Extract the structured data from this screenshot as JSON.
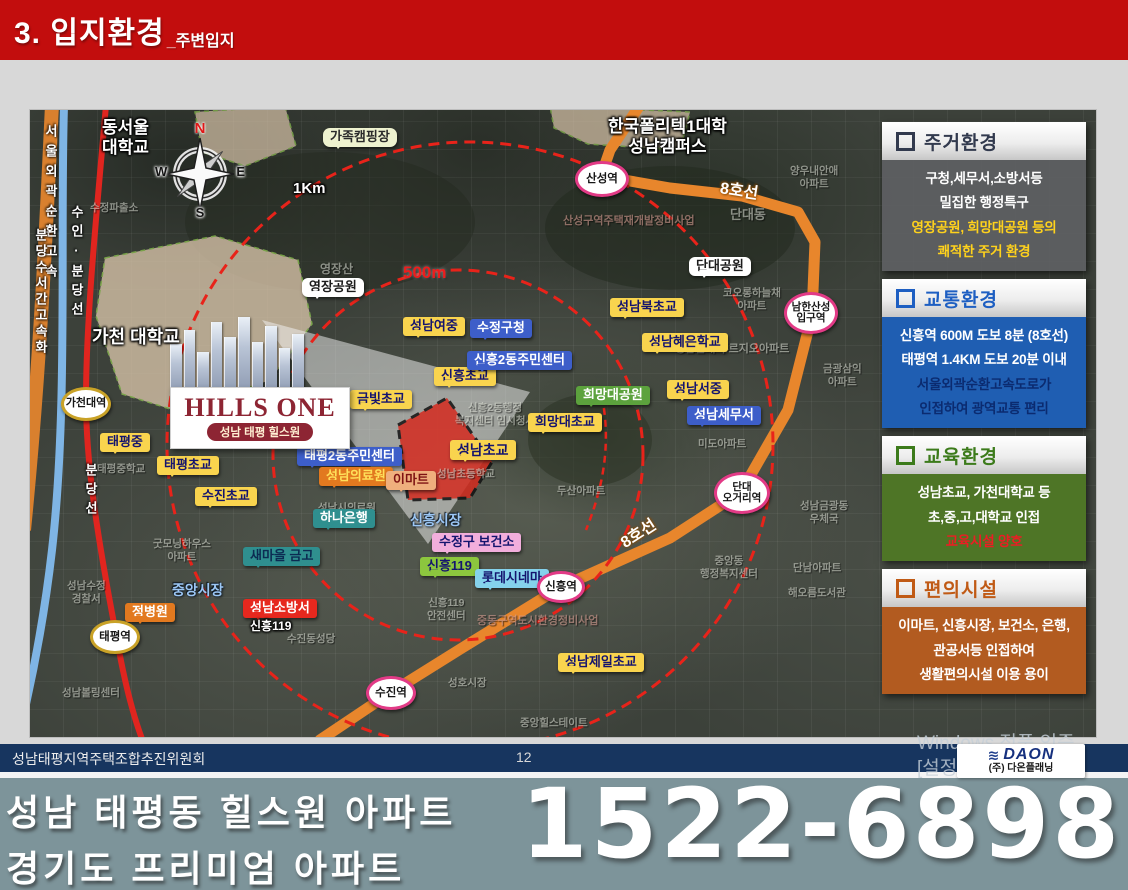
{
  "header": {
    "title": "3. 입지환경",
    "subtitle": "_주변입지"
  },
  "colors": {
    "header_bar": "#C20D0D",
    "line8_subway": "#E8862C",
    "bundang_line": "#E0251F",
    "radius_circle": "#E8231A",
    "site_fill": "#D42B1F",
    "footer_bar": "#17355F",
    "banner_bg": "#7D949A",
    "school_label": "#F9D44E",
    "public_label": "#3D5EC9"
  },
  "sidebar": {
    "panels": [
      {
        "title": "주거환경",
        "accent": "#323A4E",
        "body_bg": "rgba(96,97,100,0.88)",
        "hl": "#FFD21C",
        "lines": [
          {
            "t": "구청,세무서,소방서등"
          },
          {
            "t": "밀집한 행정특구"
          },
          {
            "t": "영장공원, 희망대공원 등의",
            "hl": true
          },
          {
            "t": "쾌적한 주거 환경",
            "hl": true
          }
        ]
      },
      {
        "title": "교통환경",
        "accent": "#1E5FC2",
        "body_bg": "#1F5EB2",
        "hl": "#0B2B70",
        "lines": [
          {
            "t": "신흥역 600M 도보 8분 (8호선)"
          },
          {
            "t": "태평역 1.4KM 도보 20분 이내"
          },
          {
            "t": "서울외곽순환고속도로가",
            "hl": true
          },
          {
            "t": "인접하여 광역교통 편리",
            "hl": true
          }
        ]
      },
      {
        "title": "교육환경",
        "accent": "#3C7B1B",
        "body_bg": "#4E7526",
        "hl": "#ED1C24",
        "lines": [
          {
            "t": "성남초교, 가천대학교 등"
          },
          {
            "t": "초,중,고,대학교 인접"
          },
          {
            "t": "교육시설 양호",
            "hl": true
          }
        ]
      },
      {
        "title": "편의시설",
        "accent": "#C05A15",
        "body_bg": "#B25B20",
        "hl": "#FFFFFF",
        "lines": [
          {
            "t": "이마트, 신흥시장, 보건소, 은행,"
          },
          {
            "t": "관공서등 인접하여"
          },
          {
            "t": "생활편의시설 이용 용이"
          }
        ]
      }
    ]
  },
  "map": {
    "project": {
      "logo": "HILLS ONE",
      "sub": "성남 태평 힐스원"
    },
    "compass": {
      "n": "N",
      "w": "W",
      "e": "E",
      "s": "S"
    },
    "labels": [
      {
        "t": "성남여중",
        "type": "y",
        "x": 373,
        "y": 207
      },
      {
        "t": "신흥초교",
        "type": "y",
        "x": 404,
        "y": 257
      },
      {
        "t": "성남북초교",
        "type": "y",
        "x": 580,
        "y": 188
      },
      {
        "t": "성남혜은학교",
        "type": "y",
        "x": 612,
        "y": 223
      },
      {
        "t": "성남서중",
        "type": "y",
        "x": 637,
        "y": 270
      },
      {
        "t": "금빛초교",
        "type": "y",
        "x": 320,
        "y": 280
      },
      {
        "t": "희망대초교",
        "type": "y",
        "x": 498,
        "y": 303
      },
      {
        "t": "성남초교",
        "type": "y",
        "x": 420,
        "y": 330,
        "fs": 14
      },
      {
        "t": "태평중",
        "type": "y",
        "x": 70,
        "y": 323
      },
      {
        "t": "태평초교",
        "type": "y",
        "x": 127,
        "y": 346
      },
      {
        "t": "수진초교",
        "type": "y",
        "x": 165,
        "y": 377
      },
      {
        "t": "성남제일초교",
        "type": "y",
        "x": 528,
        "y": 543
      },
      {
        "t": "영장공원",
        "type": "wht",
        "x": 272,
        "y": 168
      },
      {
        "t": "단대공원",
        "type": "wht",
        "x": 659,
        "y": 147
      },
      {
        "t": "가족캠핑장",
        "type": "crm",
        "x": 293,
        "y": 18
      },
      {
        "t": "수정구청",
        "type": "b",
        "x": 440,
        "y": 209
      },
      {
        "t": "신흥2동주민센터",
        "type": "b",
        "x": 437,
        "y": 241
      },
      {
        "t": "태평2동주민센터",
        "type": "b",
        "x": 267,
        "y": 337
      },
      {
        "t": "성남세무서",
        "type": "b",
        "x": 657,
        "y": 296
      },
      {
        "t": "하나은행",
        "type": "teal",
        "x": 283,
        "y": 399
      },
      {
        "t": "새마을 금고",
        "type": "tealD",
        "x": 213,
        "y": 437
      },
      {
        "t": "희망대공원",
        "type": "grn",
        "x": 546,
        "y": 276
      },
      {
        "t": "신흥119",
        "type": "lime",
        "x": 390,
        "y": 447
      },
      {
        "t": "수정구 보건소",
        "type": "pnk",
        "x": 402,
        "y": 423
      },
      {
        "t": "롯데시네마",
        "type": "cyn",
        "x": 445,
        "y": 459
      },
      {
        "t": "성남소방서",
        "type": "red",
        "x": 213,
        "y": 489
      },
      {
        "t": "정병원",
        "type": "org",
        "x": 95,
        "y": 493
      },
      {
        "t": "성남의료원",
        "type": "orgy",
        "x": 289,
        "y": 357
      },
      {
        "t": "이마트",
        "type": "tan",
        "x": 356,
        "y": 361
      },
      {
        "t": "동서울\n대학교",
        "type": "tw",
        "x": 72,
        "y": 8,
        "fs": 17
      },
      {
        "t": "한국폴리텍1대학\n성남캠퍼스",
        "type": "tw",
        "x": 578,
        "y": 7,
        "fs": 17
      },
      {
        "t": "가천 대학교",
        "type": "tw",
        "x": 62,
        "y": 217,
        "fs": 18
      },
      {
        "t": "신흥119",
        "type": "tw",
        "x": 220,
        "y": 510,
        "fs": 12
      },
      {
        "t": "1Km",
        "type": "tw",
        "x": 263,
        "y": 70,
        "fs": 15
      },
      {
        "t": "8호선",
        "type": "t8",
        "x": 690,
        "y": 70,
        "rot": 9
      },
      {
        "t": "8호선",
        "type": "t8",
        "x": 593,
        "y": 426,
        "rot": -33
      },
      {
        "t": "신흥시장",
        "type": "tb",
        "x": 380,
        "y": 402,
        "fs": 14
      },
      {
        "t": "중앙시장",
        "type": "tb",
        "x": 142,
        "y": 472,
        "fs": 14
      },
      {
        "t": "500m",
        "type": "tr",
        "x": 373,
        "y": 153
      },
      {
        "t": "서울외곽순환고속",
        "type": "vt",
        "x": 12,
        "y": 14,
        "ls": 7
      },
      {
        "t": "분당수서간고속화",
        "type": "vt",
        "x": 2,
        "y": 118,
        "ls": 3
      },
      {
        "t": "수인·분당선",
        "type": "vt",
        "x": 38,
        "y": 95,
        "ls": 6
      },
      {
        "t": "분당선",
        "type": "vt",
        "x": 52,
        "y": 353,
        "ls": 6
      }
    ],
    "stations": [
      {
        "t": "산성역",
        "c": "pink",
        "x": 545,
        "y": 51,
        "w": 54,
        "h": 36
      },
      {
        "t": "남한산성\n입구역",
        "c": "pink",
        "x": 754,
        "y": 182,
        "w": 54,
        "h": 42,
        "fs": 10.5
      },
      {
        "t": "단대\n오거리역",
        "c": "pink",
        "x": 684,
        "y": 362,
        "w": 56,
        "h": 42,
        "fs": 10.5
      },
      {
        "t": "신흥역",
        "c": "pink",
        "x": 507,
        "y": 461,
        "w": 48,
        "h": 32
      },
      {
        "t": "수진역",
        "c": "pink",
        "x": 336,
        "y": 566,
        "w": 50,
        "h": 34
      },
      {
        "t": "가천대역",
        "c": "gold",
        "x": 31,
        "y": 277,
        "w": 50,
        "h": 34,
        "fs": 11
      },
      {
        "t": "태평역",
        "c": "gold",
        "x": 60,
        "y": 510,
        "w": 50,
        "h": 34
      }
    ],
    "bg_texts": [
      {
        "t": "수정파출소",
        "x": 60,
        "y": 92
      },
      {
        "t": "영장산",
        "x": 290,
        "y": 152,
        "fs": 12
      },
      {
        "t": "산성구역주택재개발정비사업",
        "x": 533,
        "y": 105,
        "v": true,
        "fs": 11
      },
      {
        "t": "단대동",
        "x": 700,
        "y": 97,
        "fs": 13
      },
      {
        "t": "양우내안애\n아파트",
        "x": 760,
        "y": 55
      },
      {
        "t": "코오롱하늘채\n아파트",
        "x": 693,
        "y": 177
      },
      {
        "t": "성남단대 푸르지오아파트",
        "x": 645,
        "y": 233,
        "fs": 11
      },
      {
        "t": "금광삼익\n아파트",
        "x": 793,
        "y": 253
      },
      {
        "t": "두산아파트",
        "x": 527,
        "y": 375
      },
      {
        "t": "미도아파트",
        "x": 668,
        "y": 328
      },
      {
        "t": "성남시의료원",
        "x": 288,
        "y": 392
      },
      {
        "t": "성남초등학교",
        "x": 407,
        "y": 358
      },
      {
        "t": "신흥2동행정\n복지센터 임시청사",
        "x": 425,
        "y": 292
      },
      {
        "t": "굿모닝하우스\n아파트",
        "x": 123,
        "y": 428
      },
      {
        "t": "성남수정\n경찰서",
        "x": 37,
        "y": 470
      },
      {
        "t": "태평중학교",
        "x": 67,
        "y": 353
      },
      {
        "t": "수진동성당",
        "x": 257,
        "y": 523
      },
      {
        "t": "성남볼링센터",
        "x": 32,
        "y": 577
      },
      {
        "t": "중앙힐스테이트",
        "x": 490,
        "y": 607
      },
      {
        "t": "성호시장",
        "x": 418,
        "y": 567
      },
      {
        "t": "단남아파트",
        "x": 763,
        "y": 452
      },
      {
        "t": "중앙동\n행정복지센터",
        "x": 670,
        "y": 445
      },
      {
        "t": "해오름도서관",
        "x": 758,
        "y": 477
      },
      {
        "t": "성남금광동\n우체국",
        "x": 770,
        "y": 390
      },
      {
        "t": "중동구역도시환경정비사업",
        "x": 447,
        "y": 505,
        "v": true,
        "fs": 11
      },
      {
        "t": "신흥119\n안전센터",
        "x": 397,
        "y": 487
      }
    ]
  },
  "footer": {
    "committee": "성남태평지역주택조합추진위원회",
    "page": "12"
  },
  "banner": {
    "line1": "성남 태평동 힐스원 아파트",
    "line2": "경기도 프리미엄 아파트",
    "phone": "1522-6898"
  },
  "watermark": {
    "line1": "Windows 정품 인증",
    "line2": "[설정]으로 이"
  },
  "logo": {
    "name": "DAON",
    "company": "(주) 다온플래닝"
  }
}
